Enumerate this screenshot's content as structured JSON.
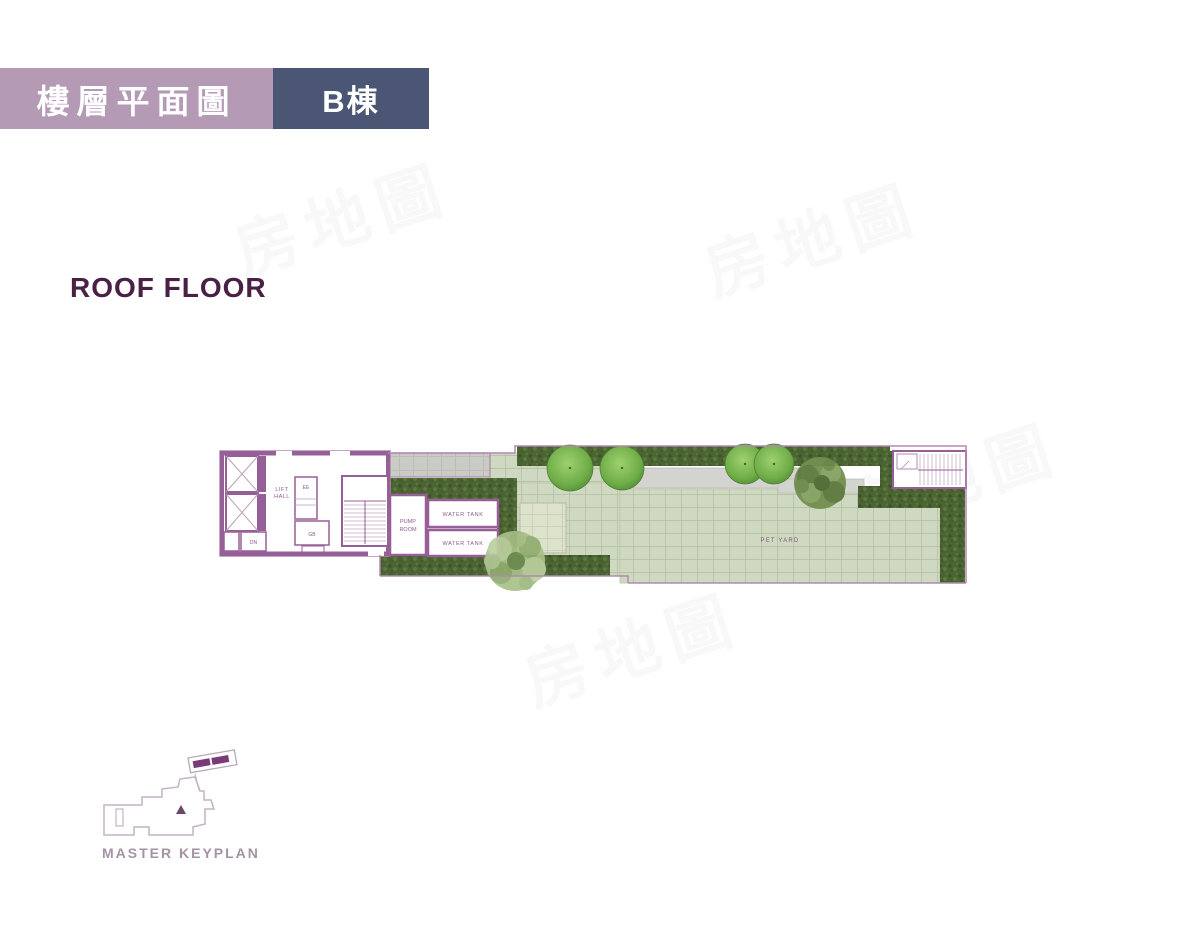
{
  "header": {
    "tab_floor_plan": "樓層平面圖",
    "tab_building": "B棟"
  },
  "title": "ROOF FLOOR",
  "watermark": "房地圖",
  "plan": {
    "labels": {
      "lift_line1": "LIFT",
      "lift_line2": "HALL",
      "ee": "EE",
      "gb": "GB",
      "dn": "DN",
      "pump_line1": "PUMP",
      "pump_line2": "ROOM",
      "water_tank_1": "WATER TANK",
      "water_tank_2": "WATER TANK",
      "pet_yard": "PET YARD"
    }
  },
  "keyplan": {
    "label": "MASTER KEYPLAN"
  },
  "colors": {
    "mauve": "#b59ab5",
    "navy": "#4a5674",
    "title_purple": "#4a2145",
    "wall_purple": "#975f97",
    "outline_purple": "#b08ab0",
    "label_purple": "#8a5c8a",
    "hedge_green": "#4c6433",
    "paving_green": "#cfd9c1",
    "paving_pale": "#dde3cb",
    "tree_green": "#6fae48",
    "gravel_gray": "#cbcbc6",
    "keyplan_gray": "#a393a3",
    "highlight_purple": "#7a3a7a"
  }
}
